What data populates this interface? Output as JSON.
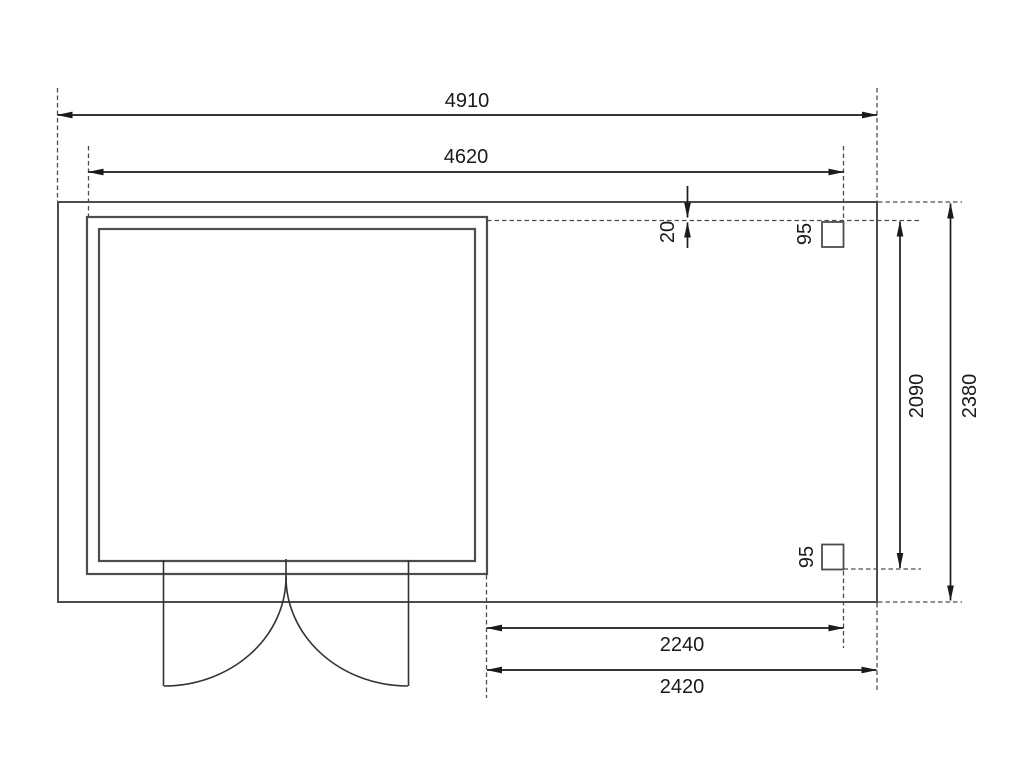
{
  "drawing": {
    "kind": "garden-house floor plan, top view with annex terrace and two posts",
    "dimension_labels": {
      "overall_width": "4910",
      "cabin_width": "4620",
      "front_offset": "20",
      "post_size_top": "95",
      "post_size_bottom": "95",
      "post_span_depth": "2090",
      "overall_depth": "2380",
      "annex_width_to_post": "2240",
      "annex_width_total": "2420"
    },
    "colors": {
      "background": "#ffffff",
      "platform_fill": "#f2f2f2",
      "cabin_interior_fill": "#fafafa",
      "wall_fill": "#b3b3b3",
      "post_fill": "#b3b3b3",
      "structure_outline": "#4d4d4d",
      "dimension_ink": "#1a1a1a"
    }
  }
}
